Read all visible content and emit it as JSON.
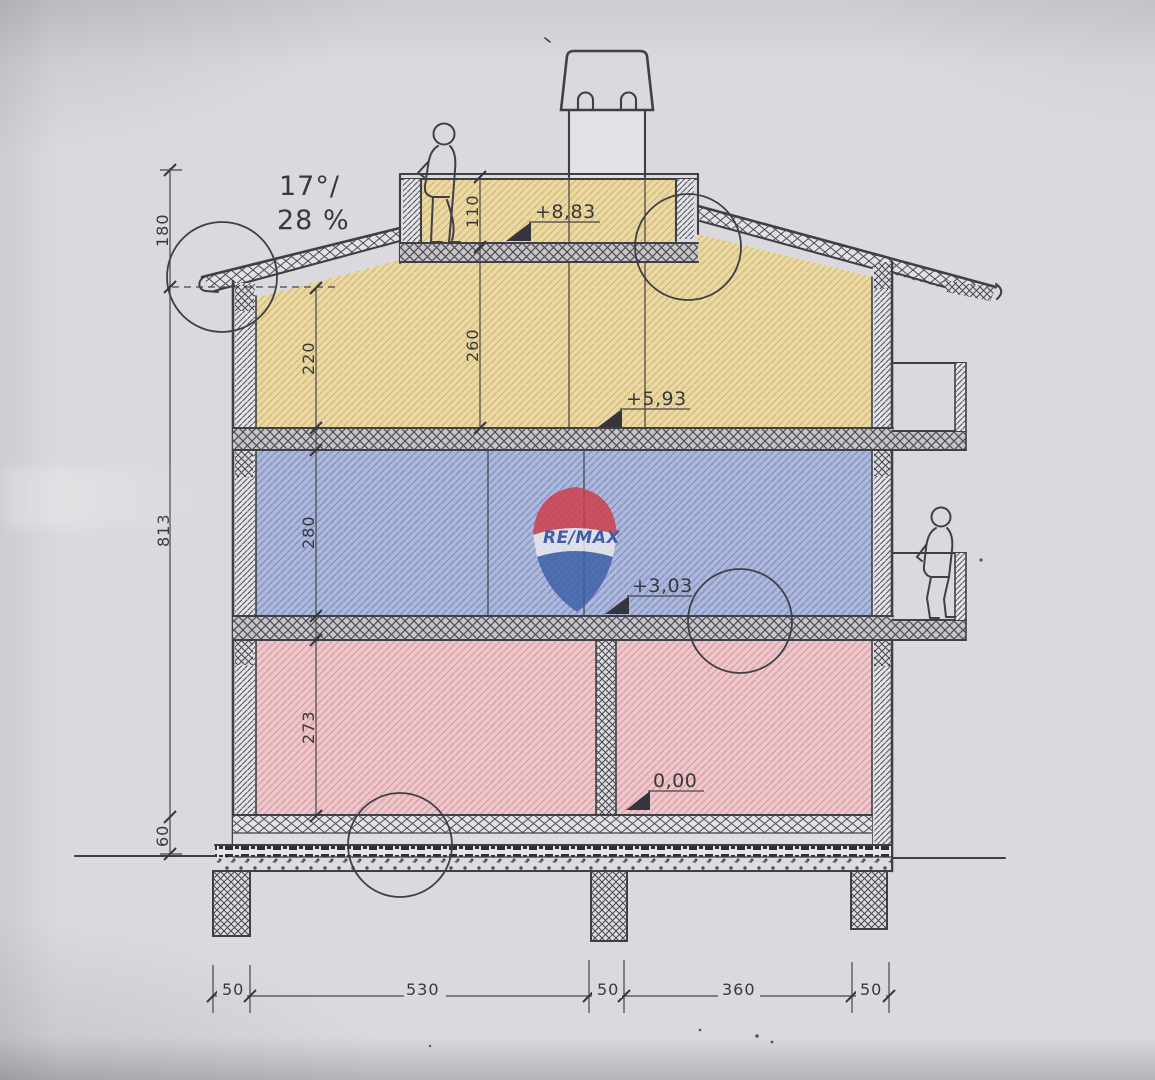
{
  "meta": {
    "type": "architectural-cross-section-scan",
    "description": "Scanned building cross-section drawing with colour-tinted storeys, elevation markers and dimension chains",
    "brand_watermark": "RE/MAX"
  },
  "annotations": {
    "roof_pitch_line1": "17°/",
    "roof_pitch_line2": "28 %",
    "watermark_text": "RE/MAX",
    "elevations": [
      {
        "id": "terrace",
        "label": "+8,83"
      },
      {
        "id": "attic-floor",
        "label": "+5,93"
      },
      {
        "id": "first-floor",
        "label": "+3,03"
      },
      {
        "id": "ground-floor",
        "label": "0,00"
      }
    ],
    "dims_left": [
      {
        "id": "eave-height",
        "label": "180"
      },
      {
        "id": "total-height",
        "label": "813"
      },
      {
        "id": "slab-package",
        "label": "60"
      }
    ],
    "dims_inner": [
      {
        "id": "attic-clear",
        "label": "220"
      },
      {
        "id": "first-clear",
        "label": "280"
      },
      {
        "id": "ground-clear",
        "label": "273"
      }
    ],
    "dims_attic": [
      {
        "id": "parapet",
        "label": "110"
      },
      {
        "id": "under-deck",
        "label": "260"
      }
    ],
    "dims_bottom": [
      {
        "id": "wall-left",
        "label": "50"
      },
      {
        "id": "bay-left",
        "label": "530"
      },
      {
        "id": "wall-mid",
        "label": "50"
      },
      {
        "id": "bay-right",
        "label": "360"
      },
      {
        "id": "wall-right",
        "label": "50"
      }
    ]
  },
  "colors": {
    "paper": "#dad9dd",
    "line": "#3f3f47",
    "attic_fill": "#ecd9a2",
    "attic_hatch": "#cfb87e",
    "floor1_fill": "#aeb8da",
    "floor1_hatch": "#8292c4",
    "ground_fill": "#eec7ca",
    "ground_hatch": "#d89aa3",
    "remax_red": "#cf3b47",
    "remax_blue": "#3c5fa8"
  }
}
